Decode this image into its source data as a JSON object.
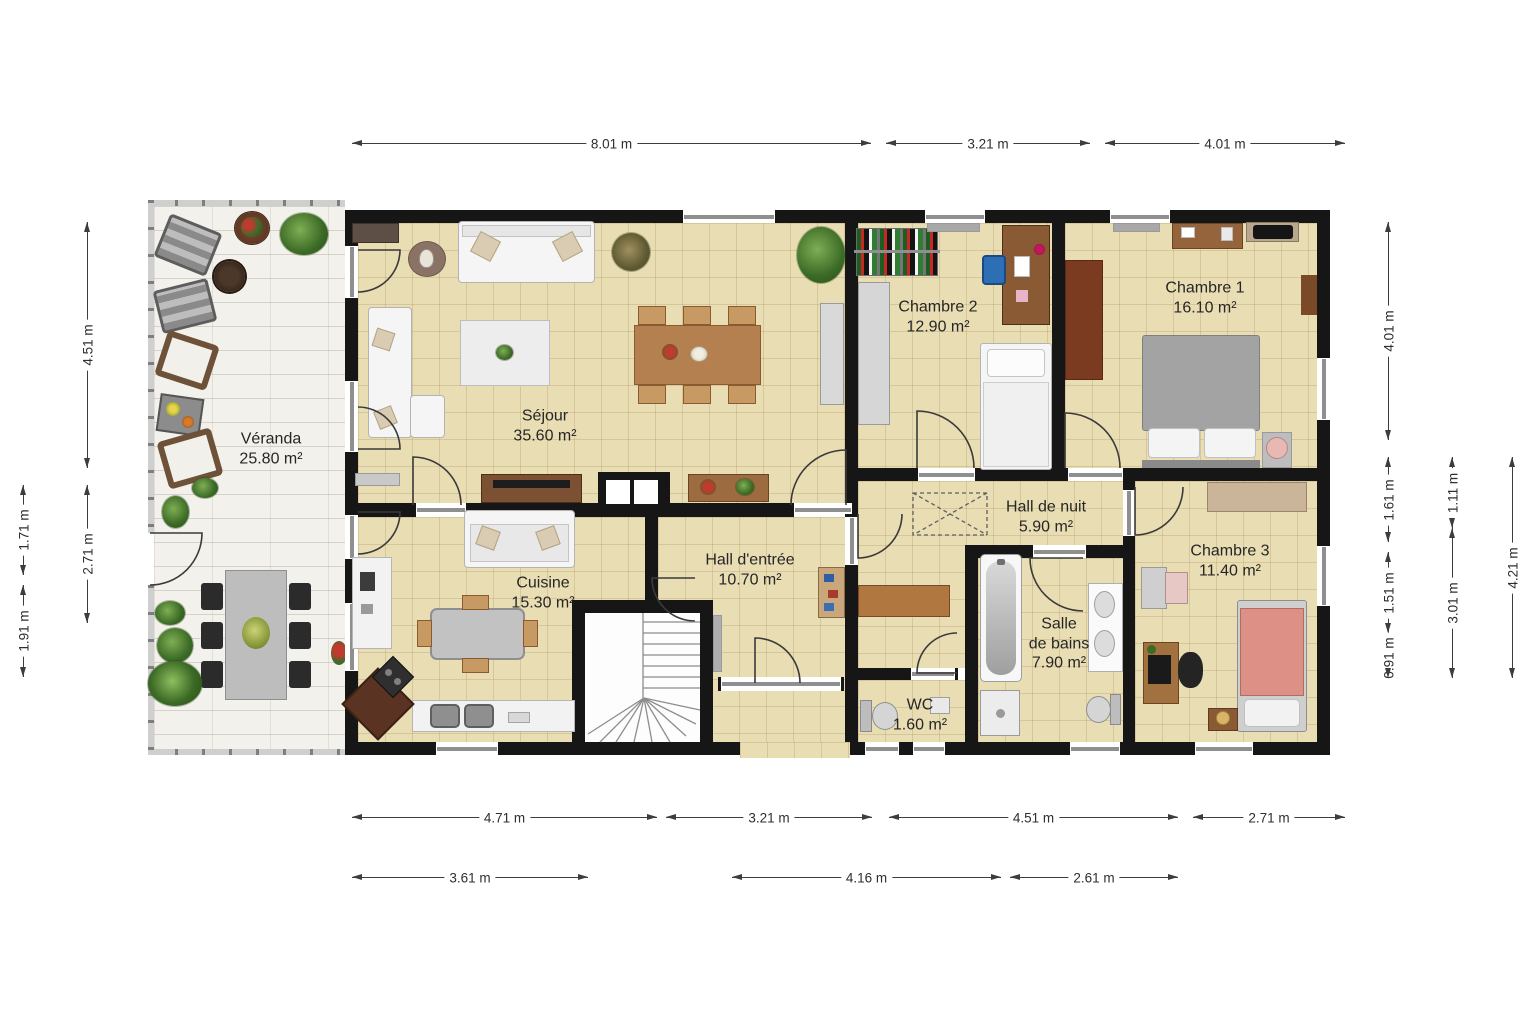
{
  "rooms": {
    "veranda": {
      "name": "Véranda",
      "area": "25.80 m²"
    },
    "sejour": {
      "name": "Séjour",
      "area": "35.60 m²"
    },
    "cuisine": {
      "name": "Cuisine",
      "area": "15.30 m²"
    },
    "hall_entree": {
      "name": "Hall d'entrée",
      "area": "10.70 m²"
    },
    "hall_de_nuit": {
      "name": "Hall de nuit",
      "area": "5.90 m²"
    },
    "chambre1": {
      "name": "Chambre 1",
      "area": "16.10 m²"
    },
    "chambre2": {
      "name": "Chambre 2",
      "area": "12.90 m²"
    },
    "chambre3": {
      "name": "Chambre 3",
      "area": "11.40 m²"
    },
    "salle_de_bains": {
      "name": "Salle\nde bains",
      "area": "7.90 m²"
    },
    "wc": {
      "name": "WC",
      "area": "1.60 m²"
    }
  },
  "dimensions": {
    "top": [
      "8.01 m",
      "3.21 m",
      "4.01 m"
    ],
    "bottom1": [
      "4.71 m",
      "3.21 m",
      "4.51 m",
      "2.71 m"
    ],
    "bottom2": [
      "3.61 m",
      "4.16 m",
      "2.61 m"
    ],
    "left_inner": [
      "4.51 m",
      "2.71 m"
    ],
    "left_outer": [
      "1.71 m",
      "1.91 m"
    ],
    "right_inner": [
      "4.01 m",
      "1.61 m",
      "1.51 m",
      "0.91 m"
    ],
    "right_mid": [
      "1.11 m",
      "3.01 m"
    ],
    "right_outer": [
      "4.21 m"
    ]
  },
  "colors": {
    "wall": "#161616",
    "room_floor": "#e9ddb4",
    "veranda_floor": "#f3f1ec",
    "window_bar": "#8f8f8f",
    "dimension_line": "#3d3d3d",
    "wood": "#b5804f",
    "bed3_pink": "#dd9186",
    "bed1_gray": "#a3a3a3",
    "plant_green": "#3c6b26"
  }
}
